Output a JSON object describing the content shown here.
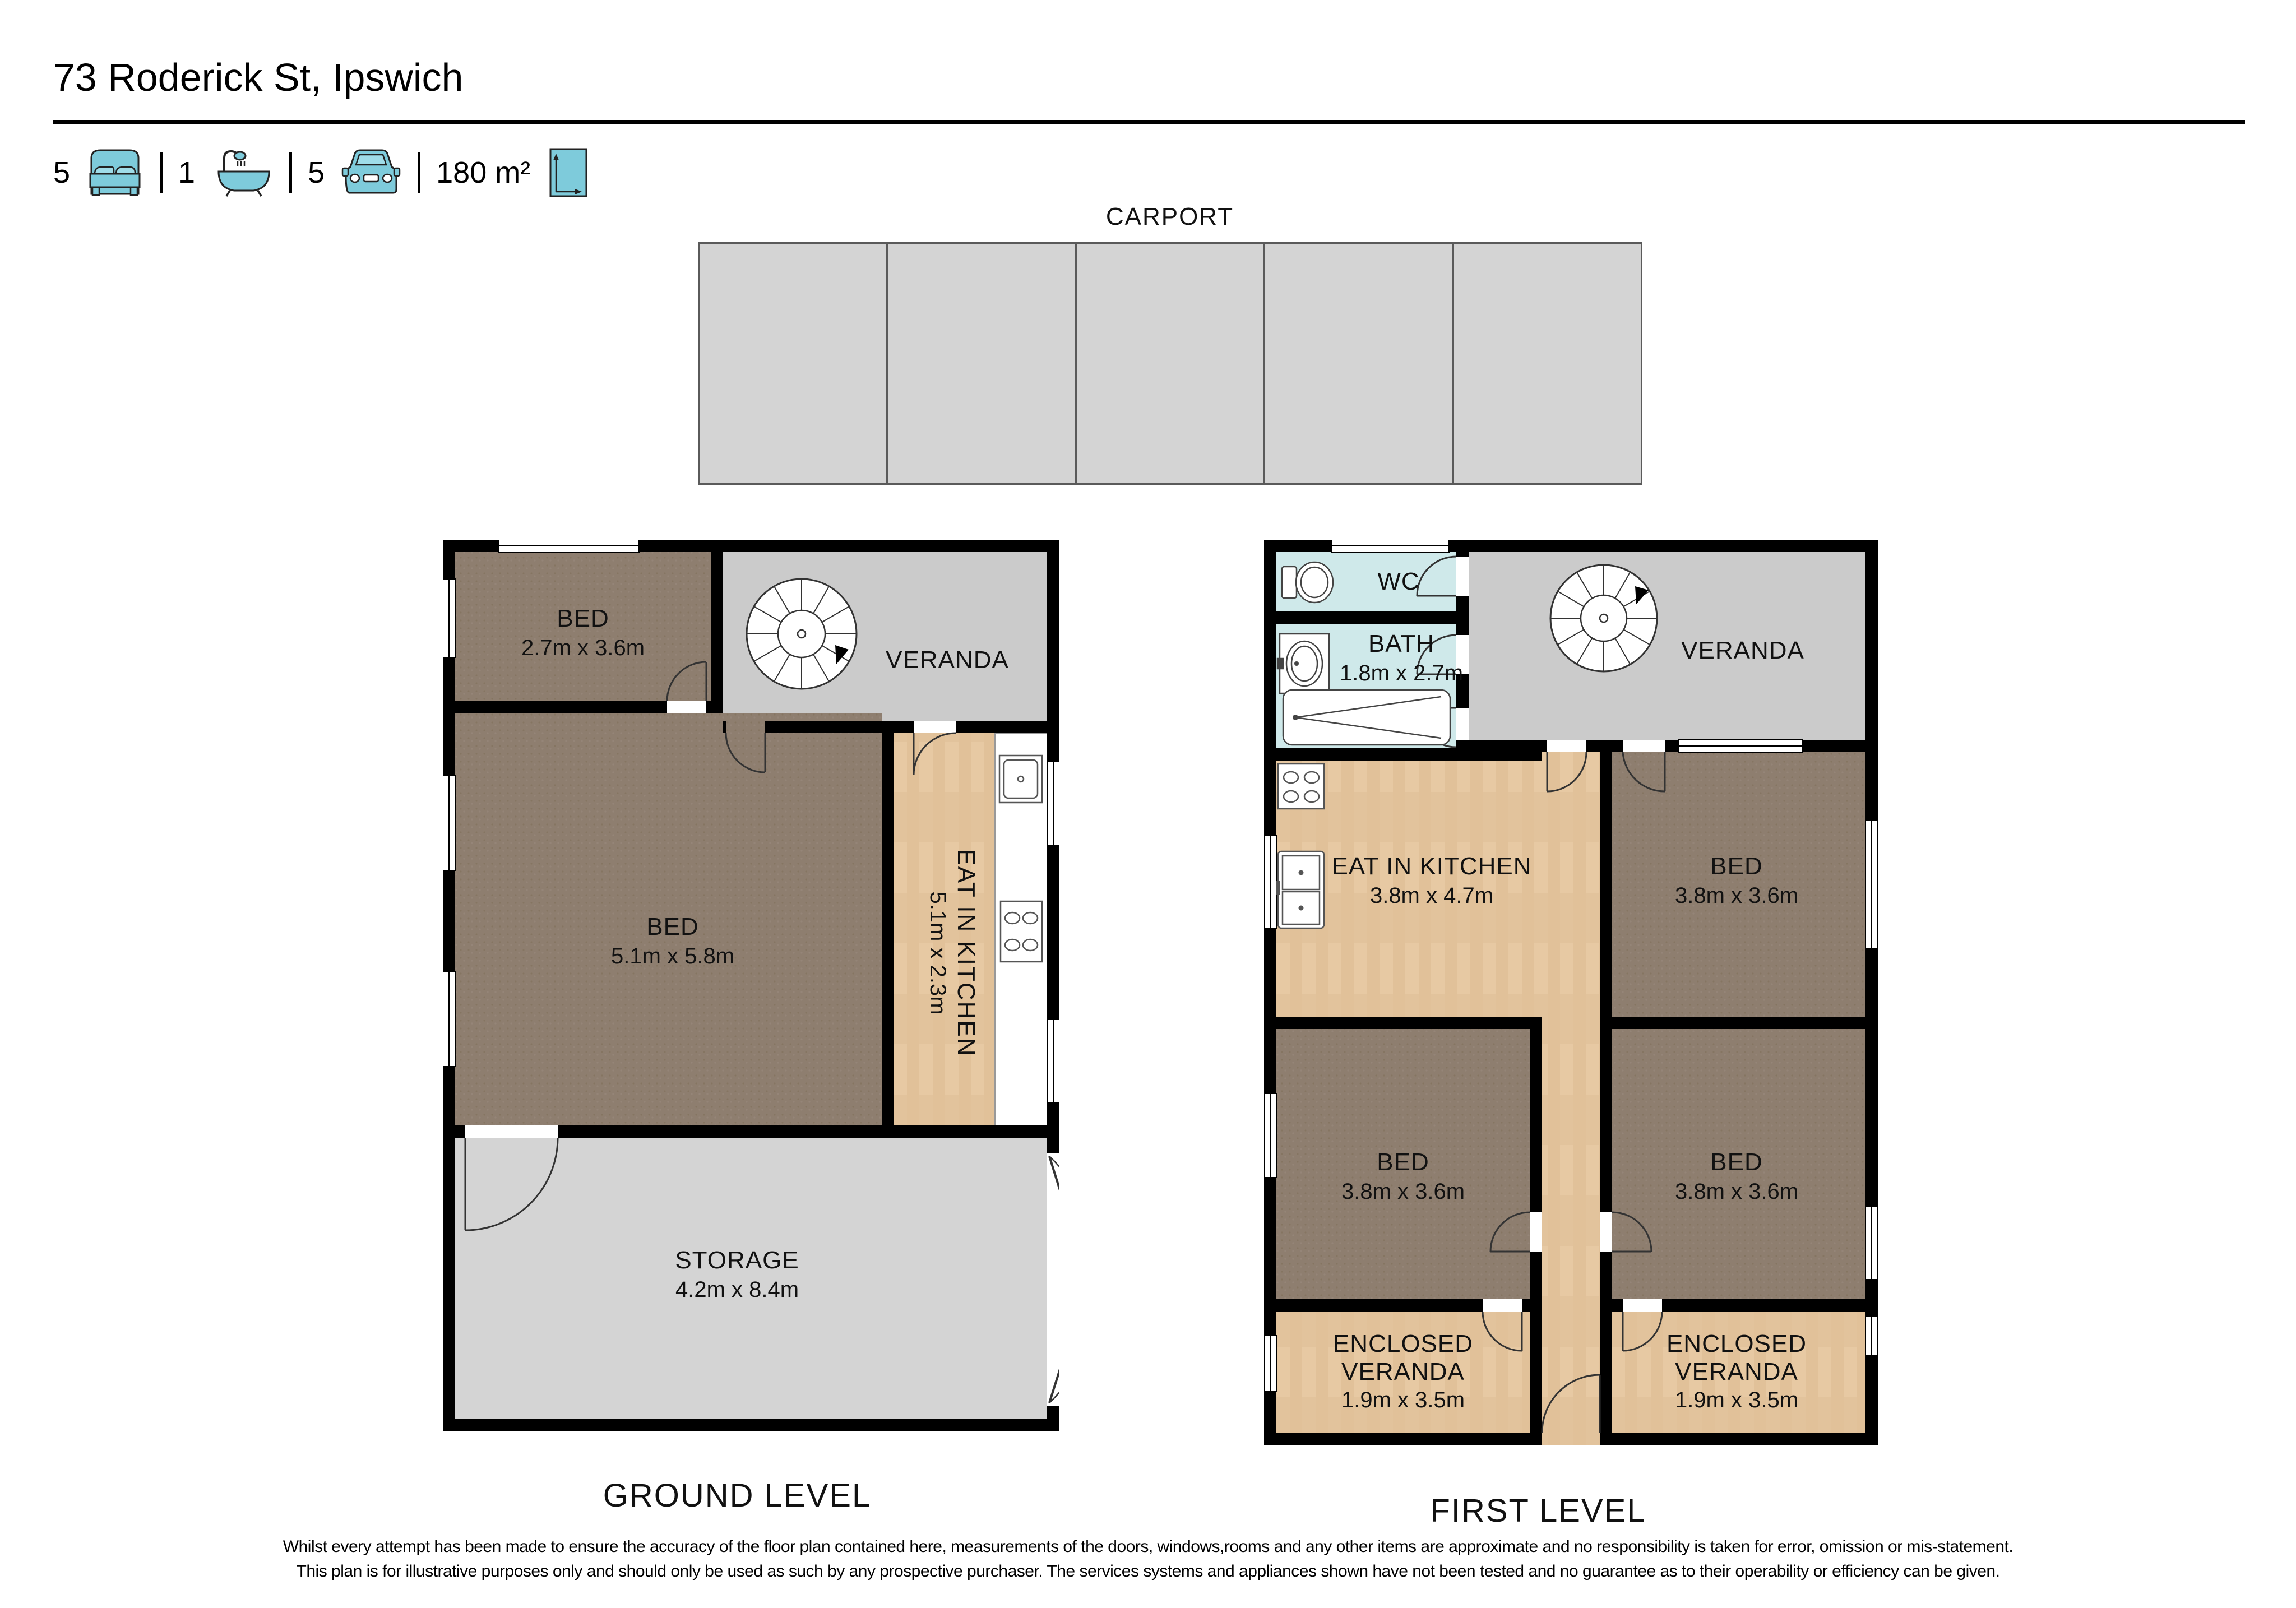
{
  "header": {
    "title": "73 Roderick St, Ipswich",
    "stats": {
      "beds": "5",
      "baths": "1",
      "cars": "5",
      "area": "180 m²"
    }
  },
  "carport": {
    "label": "CARPORT",
    "bays": 5
  },
  "ground": {
    "level_label": "GROUND LEVEL",
    "rooms": {
      "bed_small": {
        "name": "BED",
        "dims": "2.7m x 3.6m"
      },
      "veranda": {
        "name": "VERANDA"
      },
      "bed_large": {
        "name": "BED",
        "dims": "5.1m x 5.8m"
      },
      "kitchen": {
        "name": "EAT IN KITCHEN",
        "dims": "5.1m x 2.3m"
      },
      "storage": {
        "name": "STORAGE",
        "dims": "4.2m x 8.4m"
      }
    }
  },
  "first": {
    "level_label": "FIRST LEVEL",
    "rooms": {
      "wc": {
        "name": "WC"
      },
      "bath": {
        "name": "BATH",
        "dims": "1.8m x 2.7m"
      },
      "veranda": {
        "name": "VERANDA"
      },
      "kitchen": {
        "name": "EAT IN KITCHEN",
        "dims": "3.8m x 4.7m"
      },
      "bed_top_right": {
        "name": "BED",
        "dims": "3.8m x 3.6m"
      },
      "bed_mid_left": {
        "name": "BED",
        "dims": "3.8m x 3.6m"
      },
      "bed_mid_right": {
        "name": "BED",
        "dims": "3.8m x 3.6m"
      },
      "enclosed_veranda_left": {
        "name": "ENCLOSED VERANDA",
        "dims": "1.9m x 3.5m"
      },
      "enclosed_veranda_right": {
        "name": "ENCLOSED VERANDA",
        "dims": "1.9m x 3.5m"
      }
    }
  },
  "disclaimer": {
    "line1": "Whilst every attempt has been made to ensure the accuracy of the floor plan contained here, measurements of the doors, windows,rooms and any other items are approximate and no responsibility is taken for error, omission or mis-statement.",
    "line2": "This plan is for illustrative purposes only and should only be used as such by any prospective purchaser. The services systems and appliances shown have not been tested and no guarantee as to their operability or efficiency can be given."
  },
  "colors": {
    "icon_teal": "#7ecbdb",
    "wall_black": "#000000",
    "carpet_brown": "#8e7e6f",
    "wood_floor": "#e7c9a3",
    "bath_blue": "#cfe9ea",
    "veranda_gray": "#cbcbcb",
    "storage_gray": "#d4d4d4"
  }
}
